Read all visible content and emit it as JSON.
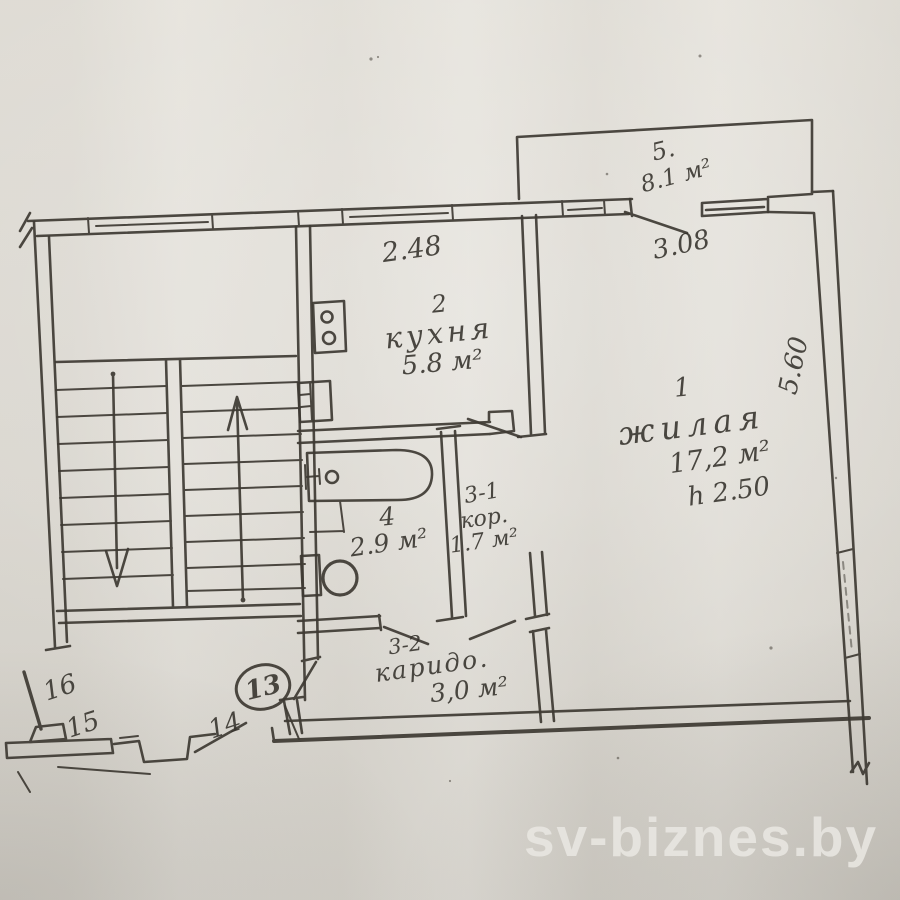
{
  "watermark": {
    "text": "sv-biznes.by"
  },
  "plan": {
    "rooms": {
      "living": {
        "number": "1",
        "name": "жилая",
        "area": "17,2 м²",
        "ceiling": "h 2.50"
      },
      "kitchen": {
        "number": "2",
        "name": "кухня",
        "area": "5.8 м²"
      },
      "corridor": {
        "number": "3-1",
        "name": "кор.",
        "area": "1.7 м²"
      },
      "bathroom": {
        "number": "4",
        "area": "2.9 м²"
      },
      "hallway": {
        "number": "3-2",
        "name": "каридо.",
        "area": "3,0 м²"
      },
      "balcony": {
        "number": "5.",
        "area": "8.1 м²"
      }
    },
    "dimensions": {
      "kitchen_width": "2.48",
      "balcony_width": "3.08",
      "living_depth": "5.60"
    },
    "markers": {
      "entrance_door": "13",
      "m14": "14",
      "m15": "15",
      "m16": "16"
    },
    "colors": {
      "ink": "#3e3a33",
      "paper": "#dfdcd5",
      "watermark": "#e9e7e2"
    }
  }
}
